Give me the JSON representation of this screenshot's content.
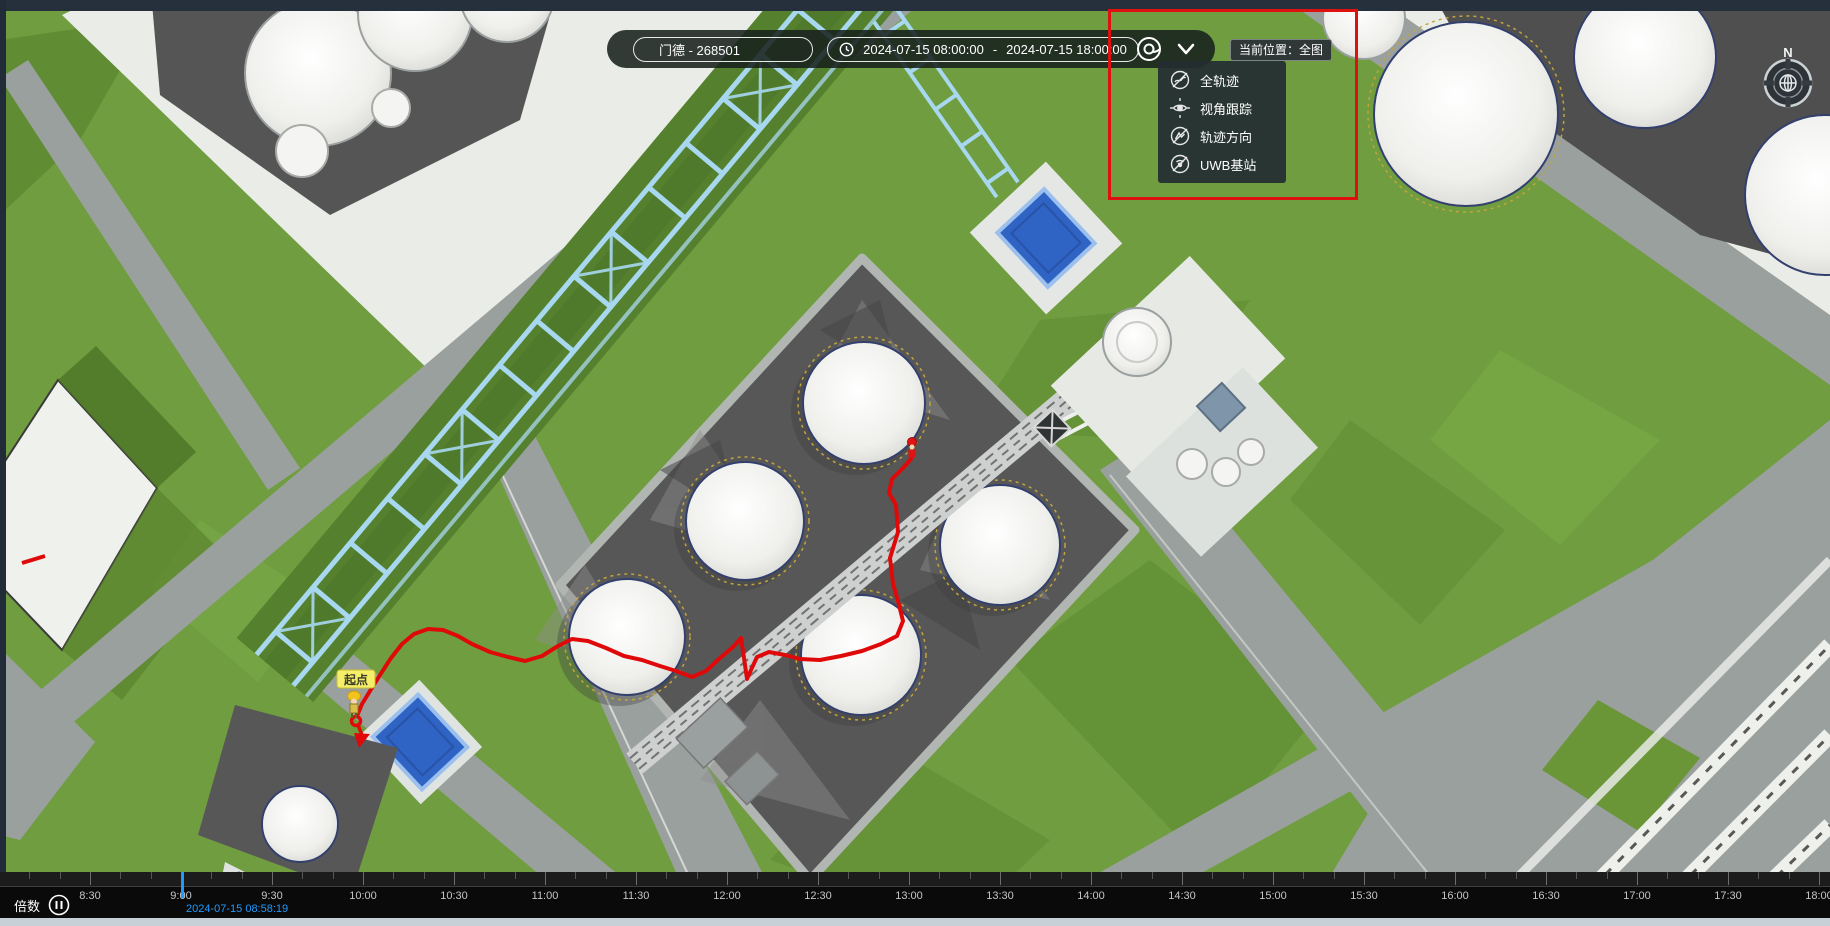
{
  "toolbar": {
    "person_tag": "门德 - 268501",
    "time_start": "2024-07-15 08:00:00",
    "time_separator": "-",
    "time_end": "2024-07-15 18:00:00"
  },
  "dropdown": {
    "items": [
      {
        "label": "全轨迹",
        "icon": "track-circle-icon"
      },
      {
        "label": "视角跟踪",
        "icon": "eye-tracking-icon"
      },
      {
        "label": "轨迹方向",
        "icon": "track-direction-icon"
      },
      {
        "label": "UWB基站",
        "icon": "uwb-station-icon"
      }
    ]
  },
  "location_badge": "当前位置：全图",
  "map": {
    "start_label": "起点",
    "compass_north": "N"
  },
  "timeline": {
    "speed_label": "倍数",
    "current_time": "2024-07-15 08:58:19",
    "ticks": [
      "8:30",
      "9:00",
      "9:30",
      "10:00",
      "10:30",
      "11:00",
      "11:30",
      "12:00",
      "12:30",
      "13:00",
      "13:30",
      "14:00",
      "14:30",
      "15:00",
      "15:30",
      "16:00",
      "16:30",
      "17:00",
      "17:30",
      "18:00"
    ]
  },
  "colors": {
    "trajectory_red": "#e00909",
    "highlight_red": "#de1010",
    "playhead_blue": "#1f9bff",
    "pool_blue": "#2f63c4",
    "start_label_yellow": "#f5ee6a",
    "grass_green": "#6f9d3f",
    "pipeline_blue": "#a8d8f0"
  }
}
